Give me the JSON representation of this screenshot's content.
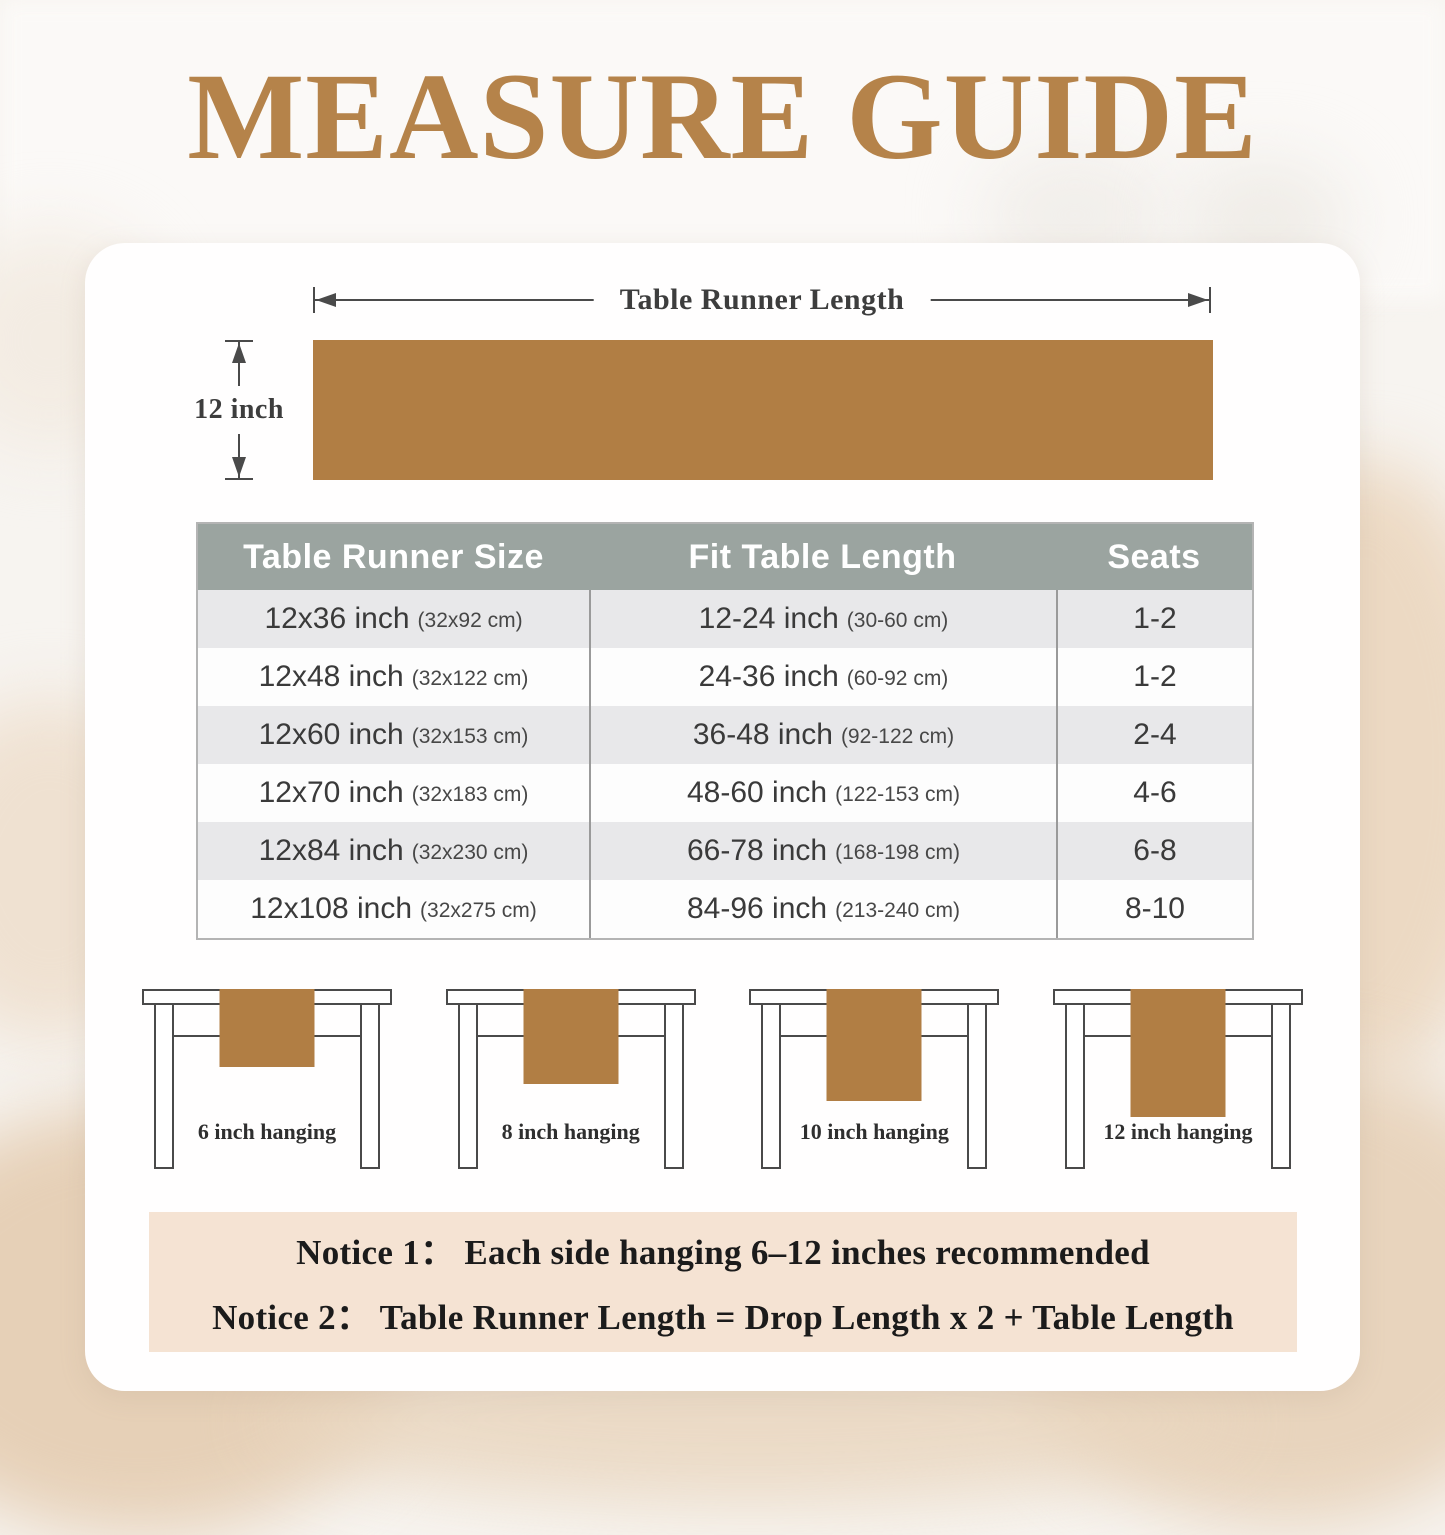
{
  "colors": {
    "accent_brown": "#b5834a",
    "runner_brown": "#b17e44",
    "header_bg": "#9ba4a0",
    "row_alt_bg": "#e8e8ea",
    "notice_bg": "#f5e3d3"
  },
  "title": "MEASURE GUIDE",
  "diagram": {
    "length_label": "Table Runner Length",
    "width_label": "12 inch"
  },
  "size_table": {
    "headers": [
      "Table Runner Size",
      "Fit Table Length",
      "Seats"
    ],
    "rows": [
      {
        "size": "12x36 inch",
        "size_cm": "(32x92 cm)",
        "fit": "12-24 inch",
        "fit_cm": "(30-60 cm)",
        "seats": "1-2"
      },
      {
        "size": "12x48 inch",
        "size_cm": "(32x122 cm)",
        "fit": "24-36 inch",
        "fit_cm": "(60-92 cm)",
        "seats": "1-2"
      },
      {
        "size": "12x60 inch",
        "size_cm": "(32x153 cm)",
        "fit": "36-48 inch",
        "fit_cm": "(92-122 cm)",
        "seats": "2-4"
      },
      {
        "size": "12x70 inch",
        "size_cm": "(32x183 cm)",
        "fit": "48-60 inch",
        "fit_cm": "(122-153 cm)",
        "seats": "4-6"
      },
      {
        "size": "12x84 inch",
        "size_cm": "(32x230 cm)",
        "fit": "66-78 inch",
        "fit_cm": "(168-198 cm)",
        "seats": "6-8"
      },
      {
        "size": "12x108 inch",
        "size_cm": "(32x275 cm)",
        "fit": "84-96 inch",
        "fit_cm": "(213-240 cm)",
        "seats": "8-10"
      }
    ]
  },
  "hanging_examples": [
    {
      "label": "6 inch hanging"
    },
    {
      "label": "8 inch hanging"
    },
    {
      "label": "10 inch hanging"
    },
    {
      "label": "12 inch hanging"
    }
  ],
  "notice": {
    "line1": "Notice 1：  Each side hanging 6–12 inches recommended",
    "line2": "Notice 2：  Table Runner Length = Drop Length x 2 + Table Length"
  }
}
